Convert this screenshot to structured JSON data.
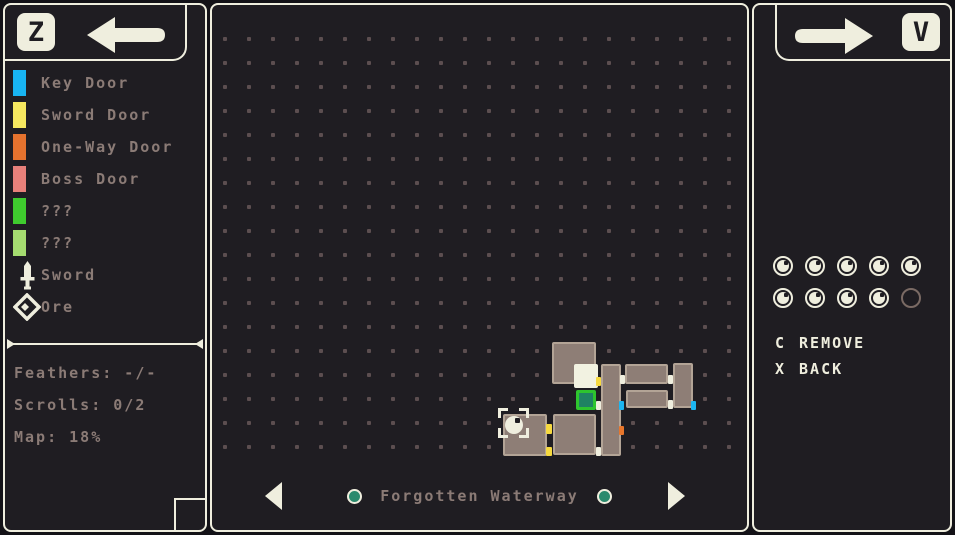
{
  "palette": {
    "cream": "#efeede",
    "page_bg": "#131217",
    "panel_bg": "#1f1d22",
    "text_muted": "#8b7b76",
    "grid_dot": "#5c4e50",
    "room_fill": "#8e7e76",
    "room_border": "#b3a496",
    "room_current": "#f2f2e1",
    "room_special_fill": "#1f8362",
    "room_special_border": "#2ec52e",
    "door_key": "#1cb5f0",
    "door_sword": "#f6d93f",
    "door_oneway": "#e8762b",
    "door_open": "#efeede",
    "nav_dot_fill": "#2b8a6d",
    "empty_slot_ring": "#7a6a64"
  },
  "left_header": {
    "key": "Z"
  },
  "right_header": {
    "key": "V"
  },
  "legend": {
    "items": [
      {
        "label": "Key Door",
        "swatch": "#18b4f2"
      },
      {
        "label": "Sword Door",
        "swatch": "#f6e75f"
      },
      {
        "label": "One-Way Door",
        "swatch": "#e5722e"
      },
      {
        "label": "Boss Door",
        "swatch": "#e8807a"
      },
      {
        "label": "???",
        "swatch": "#3fcb2e"
      },
      {
        "label": "???",
        "swatch": "#a5dc70"
      },
      {
        "label": "Sword",
        "icon": "sword-icon"
      },
      {
        "label": "Ore",
        "icon": "ore-icon"
      }
    ]
  },
  "stats": {
    "feathers": "Feathers: -/-",
    "scrolls": "Scrolls: 0/2",
    "map": "Map: 18%"
  },
  "map": {
    "region_name": "Forgotten Waterway",
    "grid": {
      "x0": 223,
      "y0": 37,
      "dx": 24,
      "dy": 24,
      "cols": 22,
      "rows": 18,
      "size": 4
    },
    "rooms": [
      {
        "x": 552,
        "y": 342,
        "w": 44,
        "h": 42,
        "type": "normal"
      },
      {
        "x": 503,
        "y": 414,
        "w": 44,
        "h": 42,
        "type": "normal"
      },
      {
        "x": 553,
        "y": 414,
        "w": 43,
        "h": 41,
        "type": "normal"
      },
      {
        "x": 601,
        "y": 364,
        "w": 20,
        "h": 92,
        "type": "normal"
      },
      {
        "x": 625,
        "y": 364,
        "w": 43,
        "h": 20,
        "type": "normal"
      },
      {
        "x": 626,
        "y": 390,
        "w": 42,
        "h": 18,
        "type": "normal"
      },
      {
        "x": 673,
        "y": 363,
        "w": 20,
        "h": 45,
        "type": "normal"
      },
      {
        "x": 574,
        "y": 364,
        "w": 24,
        "h": 24,
        "type": "current"
      },
      {
        "x": 576,
        "y": 390,
        "w": 20,
        "h": 20,
        "type": "special"
      }
    ],
    "doors": [
      {
        "x": 596,
        "y": 377,
        "w": 5,
        "h": 9,
        "type": "sword"
      },
      {
        "x": 546,
        "y": 424,
        "w": 6,
        "h": 10,
        "type": "sword"
      },
      {
        "x": 546,
        "y": 447,
        "w": 6,
        "h": 9,
        "type": "sword"
      },
      {
        "x": 620,
        "y": 375,
        "w": 5,
        "h": 9,
        "type": "open"
      },
      {
        "x": 668,
        "y": 375,
        "w": 5,
        "h": 9,
        "type": "open"
      },
      {
        "x": 668,
        "y": 400,
        "w": 5,
        "h": 9,
        "type": "open"
      },
      {
        "x": 596,
        "y": 401,
        "w": 5,
        "h": 9,
        "type": "open"
      },
      {
        "x": 596,
        "y": 447,
        "w": 5,
        "h": 9,
        "type": "open"
      },
      {
        "x": 619,
        "y": 401,
        "w": 5,
        "h": 9,
        "type": "key"
      },
      {
        "x": 691,
        "y": 401,
        "w": 5,
        "h": 9,
        "type": "key"
      },
      {
        "x": 619,
        "y": 426,
        "w": 5,
        "h": 9,
        "type": "oneway"
      }
    ],
    "player": {
      "x": 514,
      "y": 425,
      "r": 9
    },
    "cursor": {
      "x": 498,
      "y": 408,
      "w": 31,
      "h": 30
    }
  },
  "collectibles": {
    "filled": 9,
    "total": 10,
    "per_row": 5
  },
  "actions": [
    {
      "key": "C",
      "label": "REMOVE"
    },
    {
      "key": "X",
      "label": "BACK"
    }
  ]
}
